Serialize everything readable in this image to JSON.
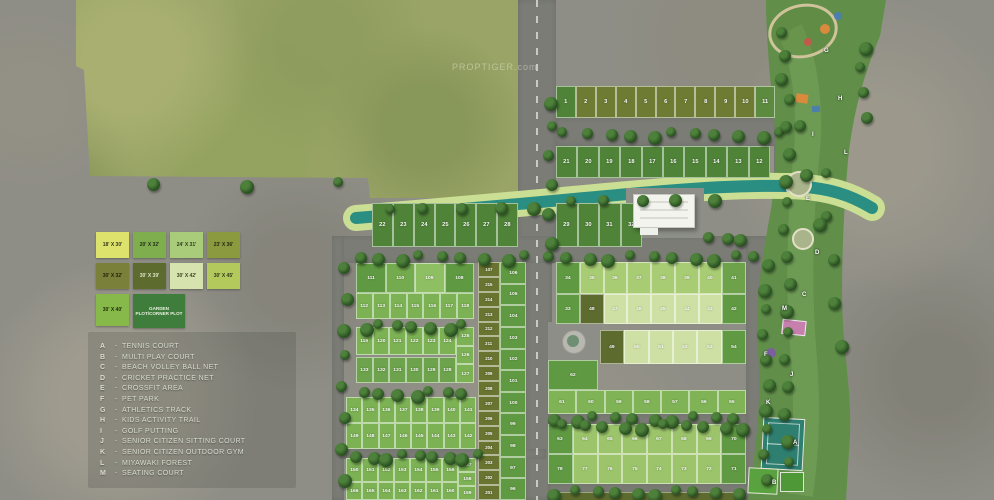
{
  "watermark": "PROPTIGER.com",
  "legend": {
    "rows": [
      [
        {
          "label": "18' X 30'",
          "color": "#dce26b",
          "text_color": "#3a3a1c"
        },
        {
          "label": "20' X 32'",
          "color": "#7fae4e",
          "text_color": "#1f2c12"
        },
        {
          "label": "24' X 31'",
          "color": "#a9cc7a",
          "text_color": "#2e3c1e"
        },
        {
          "label": "23' X 36'",
          "color": "#8c9a3f",
          "text_color": "#26290f"
        }
      ],
      [
        {
          "label": "30' X 32'",
          "color": "#7a8039",
          "text_color": "#1f220c"
        },
        {
          "label": "30' X 39'",
          "color": "#5d6b2f",
          "text_color": "#dce3c6"
        },
        {
          "label": "30' X 42'",
          "color": "#d7e3ae",
          "text_color": "#3c4420"
        },
        {
          "label": "30' X 45'",
          "color": "#b4c95c",
          "text_color": "#33391a"
        }
      ],
      [
        {
          "label": "30' X 40'",
          "color": "#86b94a",
          "text_color": "#1d2a0c",
          "tall": true
        },
        {
          "label": "GARDEN PLOT/CORNER PLOT",
          "color": "#3f7d3c",
          "text_color": "#eaf2df",
          "wide": true
        }
      ]
    ]
  },
  "amenities": [
    {
      "key": "A",
      "label": "TENNIS COURT"
    },
    {
      "key": "B",
      "label": "MULTI PLAY COURT"
    },
    {
      "key": "C",
      "label": "BEACH VOLLEY BALL NET"
    },
    {
      "key": "D",
      "label": "CRICKET PRACTICE NET"
    },
    {
      "key": "E",
      "label": "CROSSFIT AREA"
    },
    {
      "key": "F",
      "label": "PET PARK"
    },
    {
      "key": "G",
      "label": "ATHLETICS TRACK"
    },
    {
      "key": "H",
      "label": "KIDS ACTIVITY TRAIL"
    },
    {
      "key": "I",
      "label": "GOLF PUTTING"
    },
    {
      "key": "J",
      "label": "SENIOR CITIZEN SITTING COURT"
    },
    {
      "key": "K",
      "label": "SENIOR CITIZEN OUTDOOR GYM"
    },
    {
      "key": "L",
      "label": "MIYAWAKI FOREST"
    },
    {
      "key": "M",
      "label": "SEATING COURT"
    }
  ],
  "plot_rows": {
    "r1": [
      "1",
      "2",
      "3",
      "4",
      "5",
      "6",
      "7",
      "8",
      "9",
      "10",
      "11"
    ],
    "r2": [
      "21",
      "20",
      "19",
      "18",
      "17",
      "16",
      "15",
      "14",
      "13",
      "12"
    ],
    "r3a": [
      "22",
      "23",
      "24",
      "25",
      "26",
      "27",
      "28"
    ],
    "r3b": [
      "29",
      "30",
      "31",
      "32"
    ],
    "la1": [
      "111",
      "110",
      "109",
      "108"
    ],
    "la2": [
      "112",
      "113",
      "114",
      "115",
      "116",
      "117",
      "118"
    ],
    "lb1": [
      "119",
      "120",
      "121",
      "122",
      "123",
      "124"
    ],
    "lbc": [
      "125",
      "126",
      "127"
    ],
    "lb2": [
      "133",
      "132",
      "131",
      "130",
      "129",
      "128"
    ],
    "lc1": [
      "134",
      "135",
      "136",
      "137",
      "138",
      "139",
      "140",
      "141"
    ],
    "lc2": [
      "149",
      "148",
      "147",
      "146",
      "145",
      "144",
      "143",
      "142"
    ],
    "ld1": [
      "150",
      "151",
      "152",
      "153",
      "154",
      "155",
      "156"
    ],
    "ldc": [
      "157",
      "158",
      "159"
    ],
    "ld2": [
      "166",
      "165",
      "164",
      "163",
      "162",
      "161",
      "160"
    ],
    "s1": [
      "107",
      "215",
      "214",
      "213",
      "212",
      "211",
      "210",
      "209",
      "208",
      "207",
      "206",
      "205",
      "204",
      "203",
      "202",
      "201"
    ],
    "s2": [
      "106",
      "105",
      "104",
      "103",
      "102",
      "101",
      "100",
      "99",
      "98",
      "97",
      "96"
    ],
    "ra": [
      "34",
      "35",
      "36",
      "37",
      "38",
      "39",
      "40",
      "41"
    ],
    "rb": [
      "33",
      "48",
      "47",
      "46",
      "45",
      "44",
      "43",
      "42"
    ],
    "rc": [
      "49",
      "50",
      "51",
      "52",
      "53",
      "54"
    ],
    "r62": [
      "62"
    ],
    "rd": [
      "61",
      "60",
      "59",
      "58",
      "57",
      "56",
      "55"
    ],
    "re": [
      "63",
      "64",
      "65",
      "66",
      "67",
      "68",
      "69",
      "70"
    ],
    "rf": [
      "78",
      "77",
      "76",
      "75",
      "74",
      "73",
      "72",
      "71"
    ]
  },
  "row_colors": {
    "r1": "#6e7b33",
    "r2": "#4f8338",
    "r3a": "#4f8338",
    "r3b": "#4f8338",
    "la1": "#5f9a42",
    "la2": "#7cb254",
    "lb1": "#7cb254",
    "lbc": "#7cb254",
    "lb2": "#6da34c",
    "lc1": "#7cb254",
    "lc2": "#7cb254",
    "ld1": "#7cb254",
    "ldc": "#7cb254",
    "ld2": "#7cb254",
    "s1": "#68742f",
    "s2": "#5f9a42",
    "ra": "#a8cc74",
    "rb": "#cfe0a4",
    "rc": "#cfe0a4",
    "r62": "#5f9a42",
    "rd": "#7fb356",
    "re": "#9cc56b",
    "rf": "#9cc56b"
  },
  "cell_colors": {
    "r1": {
      "1": "#4f8338",
      "11": "#5c8a3f"
    },
    "la1": {
      "110": "#74ab4e",
      "109": "#8fbf63"
    },
    "ra": {
      "34": "#5f9a42",
      "41": "#6da24a"
    },
    "rb": {
      "33": "#5f9a42",
      "48": "#5d6b2f",
      "42": "#5f9a42"
    },
    "rc": {
      "49": "#5d6b2f",
      "54": "#5f9a42"
    },
    "re": {
      "63": "#5f9a42",
      "70": "#5f9a42"
    },
    "rf": {
      "78": "#5f9a42",
      "71": "#5f9a42"
    }
  },
  "map_colors": {
    "water": "#2a8e83",
    "water_bank": "#cadf93",
    "road": "#7b7c76",
    "park_strip": "#618f4a",
    "tennis_court": "#2e7f6f",
    "pink_court": "#c77fae"
  }
}
